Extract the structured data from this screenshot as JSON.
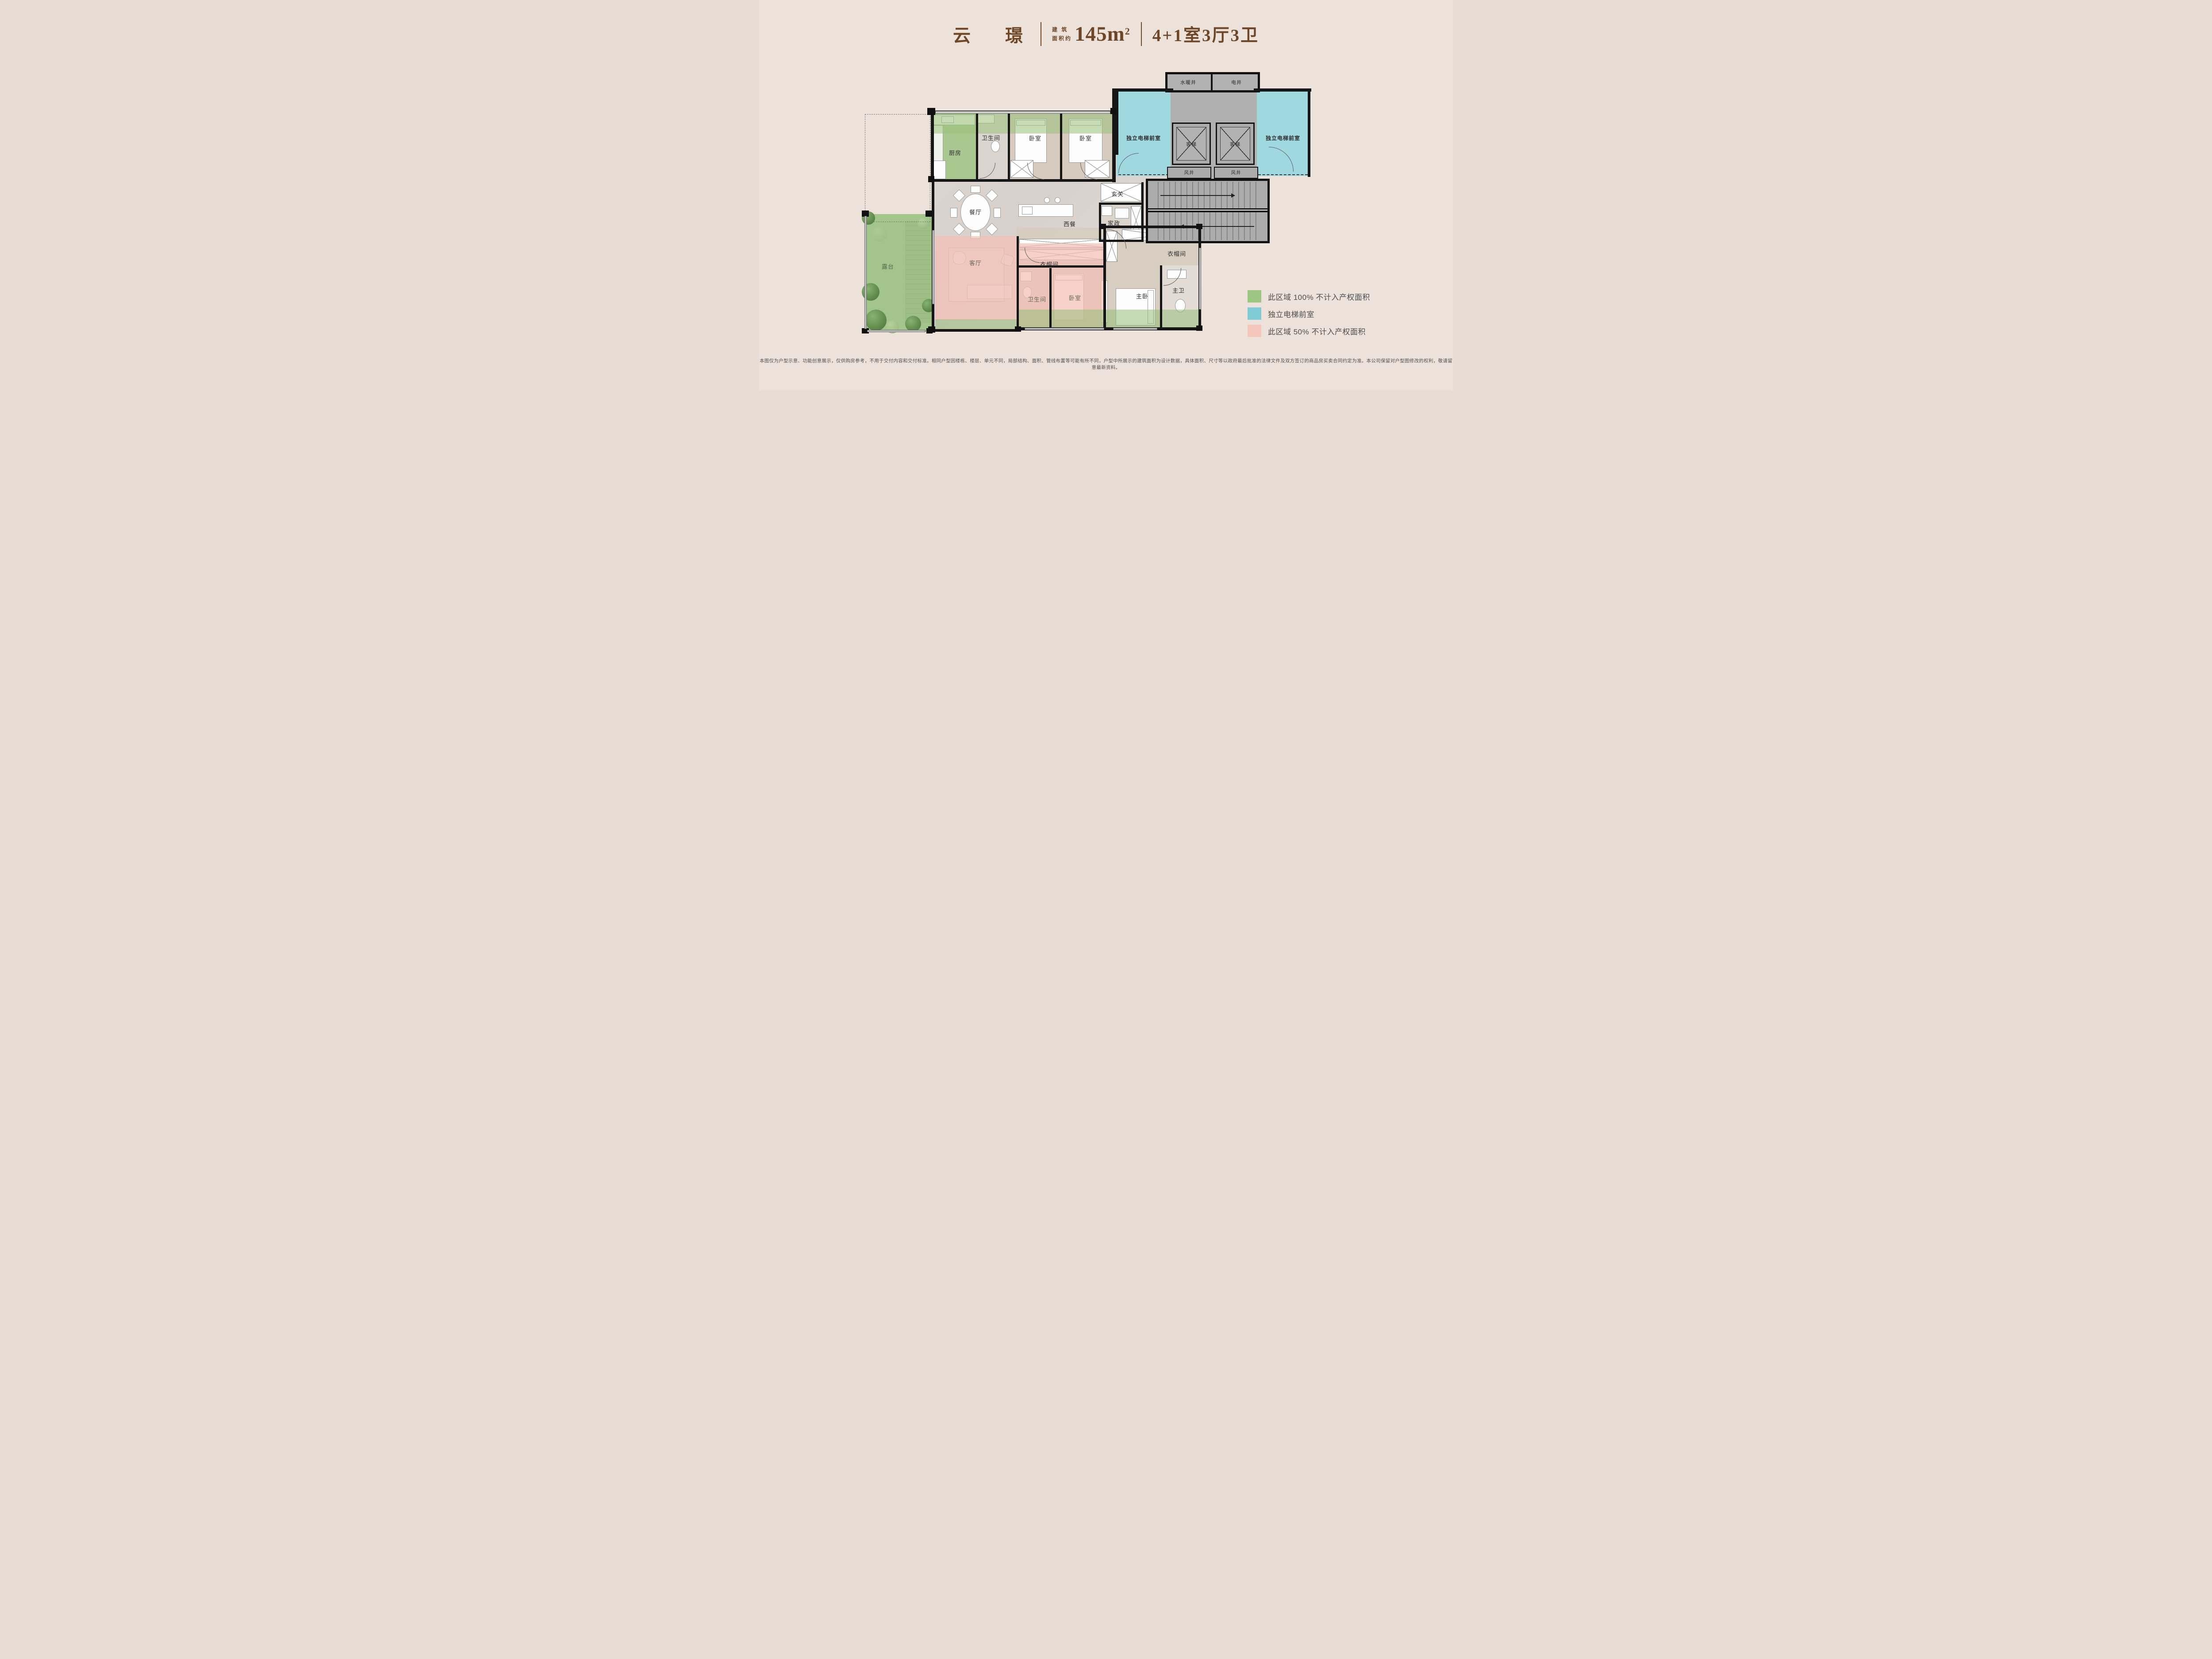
{
  "header": {
    "project_name": "云 璟",
    "area_label_line1": "建 筑",
    "area_label_line2": "面积约",
    "area_value": "145m",
    "area_sup": "2",
    "layout_spec": "4+1室3厅3卫",
    "accent_color": "#6D4728"
  },
  "plan": {
    "labels": {
      "water_heating_shaft": "水暖井",
      "electric_shaft": "电井",
      "vestibule": "独立电梯前室",
      "passenger_elevator": "客梯",
      "air_shaft": "风井",
      "kitchen": "厨房",
      "bathroom": "卫生间",
      "bedroom": "卧室",
      "entry": "玄关",
      "dining": "餐厅",
      "western_dining": "西餐",
      "housekeeping": "家政",
      "terrace": "露台",
      "living": "客厅",
      "cloakroom": "衣帽间",
      "master_bedroom": "主卧",
      "master_bath": "主卫"
    },
    "zone_colors": {
      "green_area": "#9DC583",
      "blue_vestibule": "#9FD8DF",
      "pink_area": "#F4C7BE",
      "common_gray": "#ACACAC",
      "wall": "#161616"
    }
  },
  "legend": {
    "items": [
      {
        "color": "#9DC583",
        "label": "此区域 100% 不计入产权面积"
      },
      {
        "color": "#7FCBD6",
        "label": "独立电梯前室"
      },
      {
        "color": "#F6C5BB",
        "label": "此区域 50% 不计入产权面积"
      }
    ]
  },
  "disclaimer": "本图仅为户型示意、功能创意展示，仅供购房参考，不用于交付内容和交付标准。相同户型因楼栋、楼层、单元不同，局部结构、面积、管线布置等可能有所不同，户型中所展示的建筑面积为设计数据，具体面积、尺寸等以政府最后批准的法律文件及双方签订的商品房买卖合同约定为准。本公司保留对户型图修改的权利，敬请留意最新资料。"
}
